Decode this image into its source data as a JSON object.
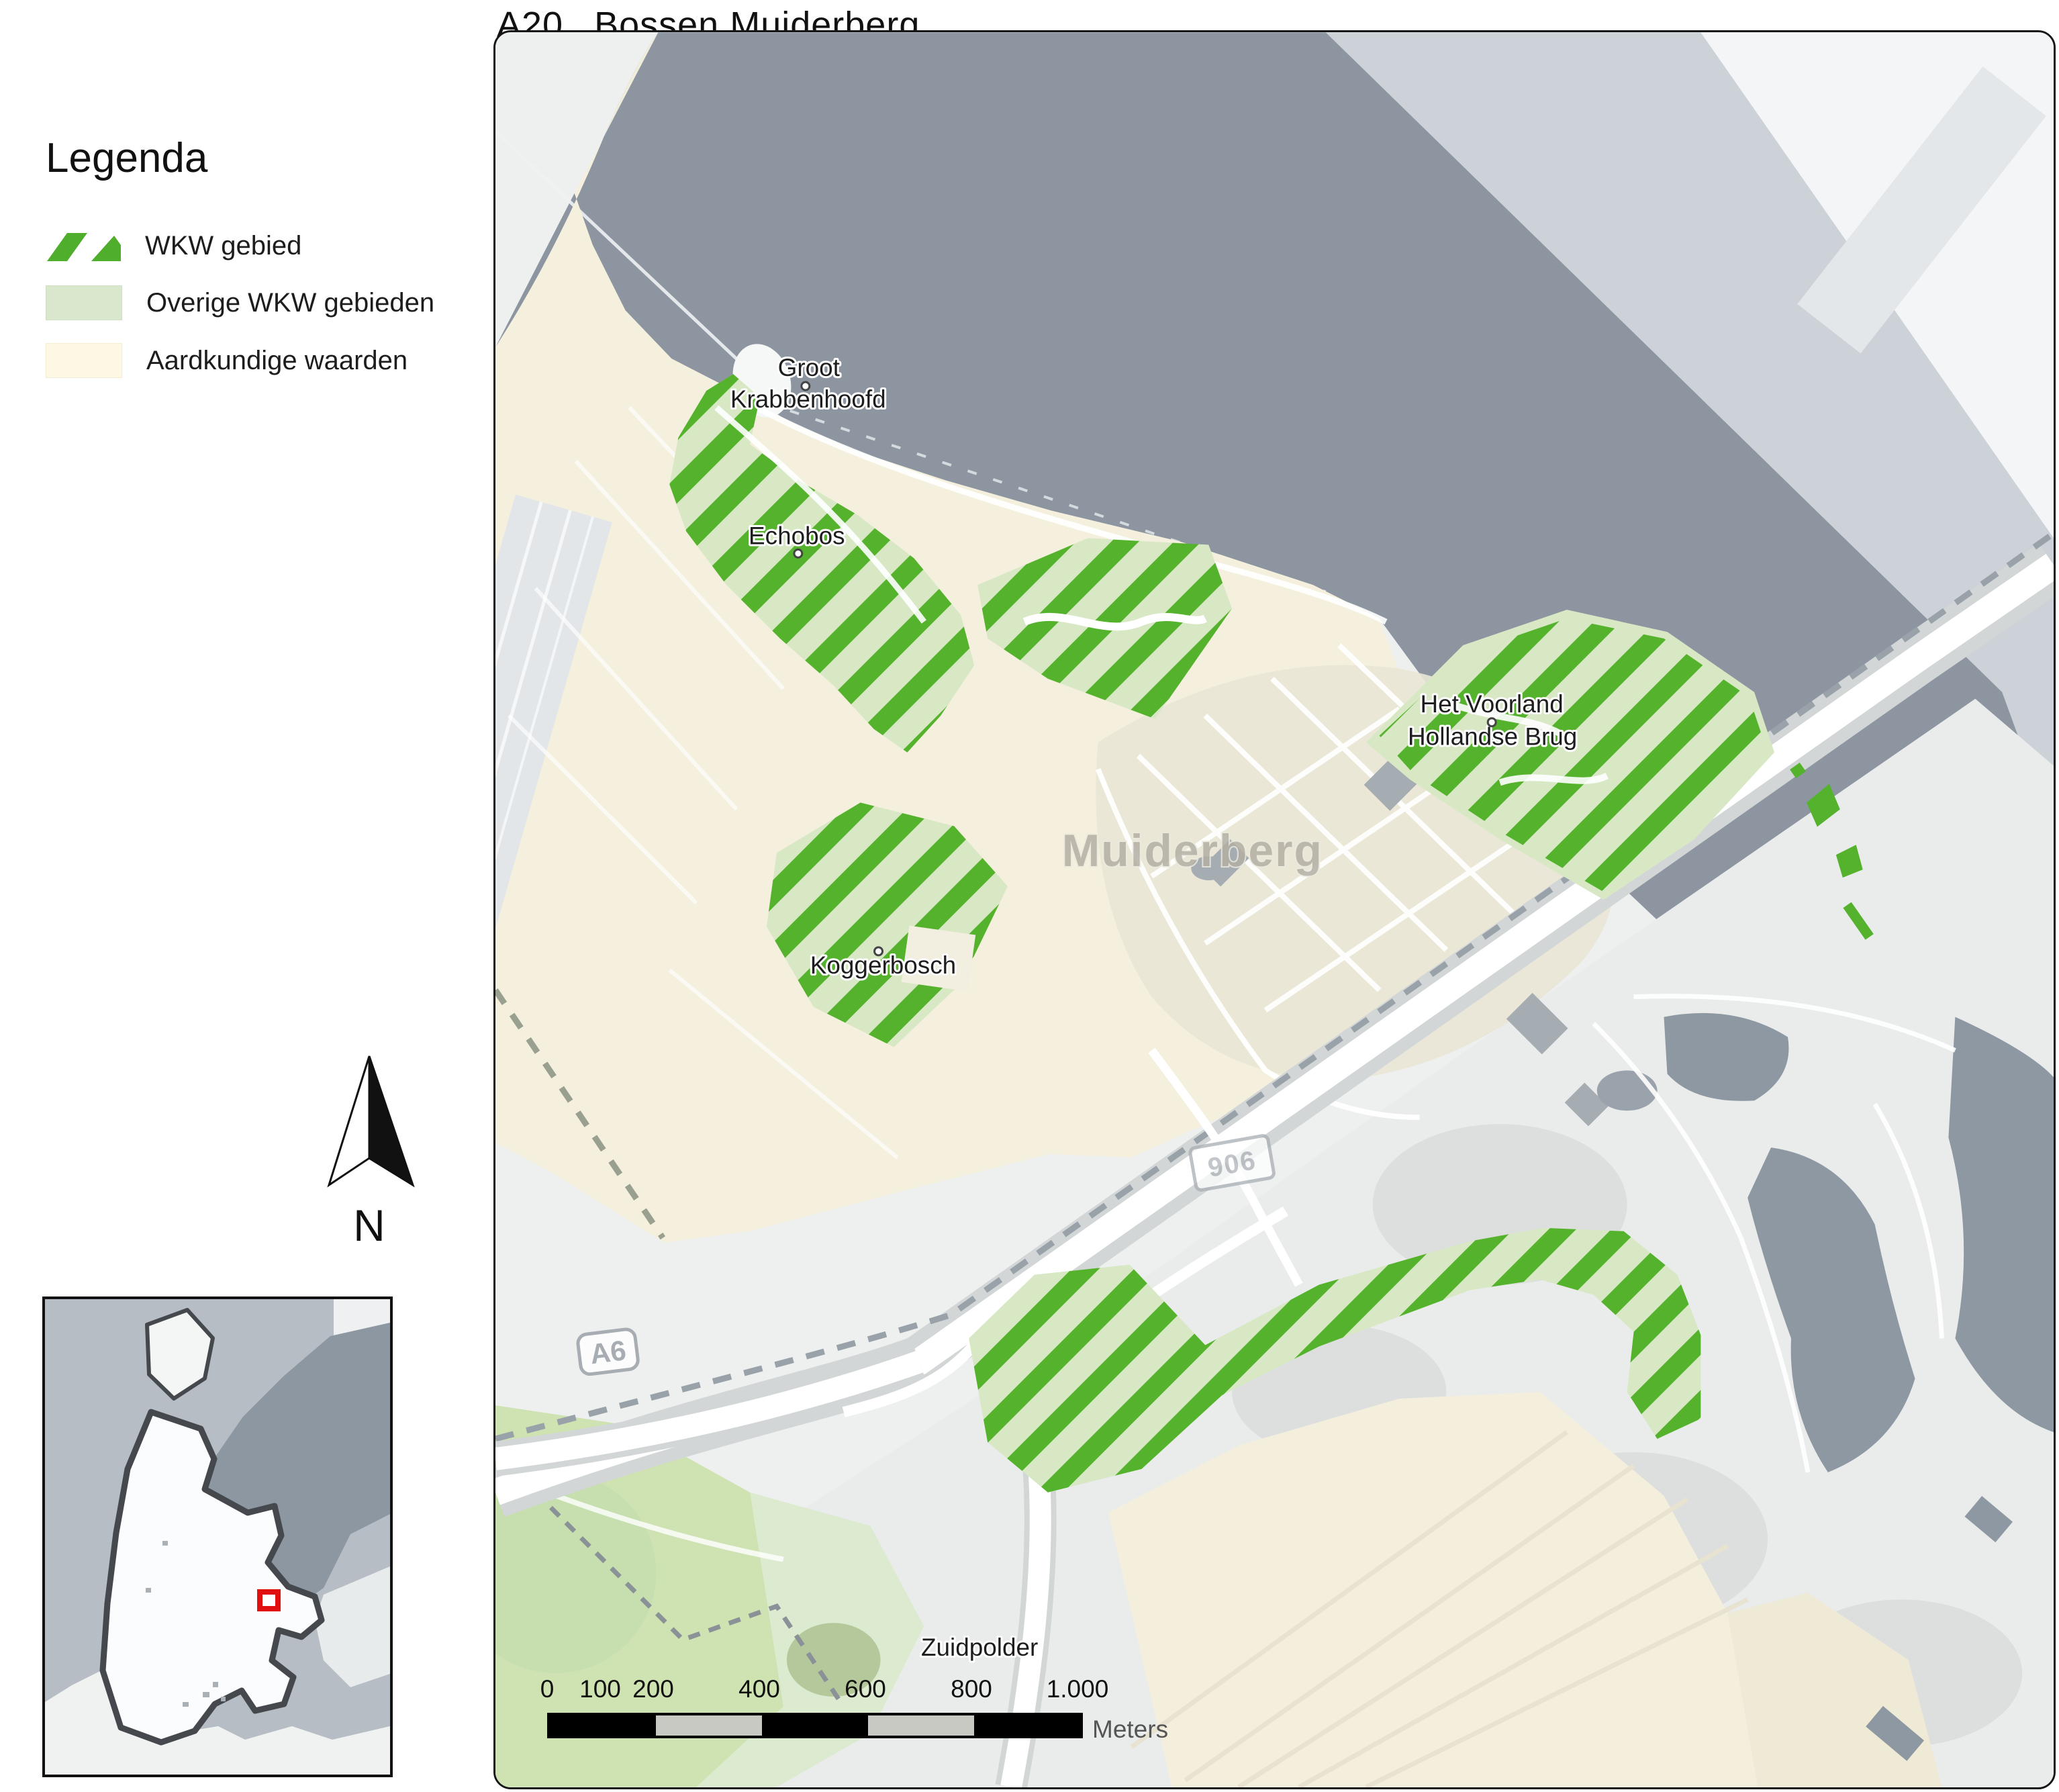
{
  "title": {
    "code": "A20",
    "name": "Bossen Muiderberg"
  },
  "legend": {
    "heading": "Legenda",
    "items": [
      {
        "label": "WKW gebied",
        "symbol": "green-diagonal-hatch",
        "color": "#4fae2b"
      },
      {
        "label": "Overige WKW gebieden",
        "symbol": "solid-fill",
        "color": "#d9e8cd"
      },
      {
        "label": "Aardkundige waarden",
        "symbol": "solid-fill",
        "color": "#fdf8e3"
      }
    ]
  },
  "north": {
    "label": "N"
  },
  "map": {
    "labels": {
      "groot_krabbenhoofd": {
        "line1": "Groot",
        "line2": "Krabbenhoofd"
      },
      "echobos": "Echobos",
      "koggerbosch": "Koggerbosch",
      "het_voorland": {
        "line1": "Het Voorland",
        "line2": "Hollandse Brug"
      },
      "muiderberg": "Muiderberg",
      "zuidpolder": "Zuidpolder"
    },
    "shields": {
      "a6": "A6",
      "n906": "906"
    },
    "colors": {
      "wkw_hatch_green": "#55b22d",
      "overige_wkw_green": "#d8e8c5",
      "aardkundige_beige": "#f4efdc",
      "water": "#8c95a0",
      "far_shore": "#ccd2d7",
      "park_green": "#cfe2b2",
      "road_white": "#ffffff"
    }
  },
  "scalebar": {
    "ticks": [
      "0",
      "100",
      "200",
      "400",
      "600",
      "800",
      "1.000"
    ],
    "unit": "Meters"
  },
  "inset": {
    "marker_color": "#e01010"
  }
}
